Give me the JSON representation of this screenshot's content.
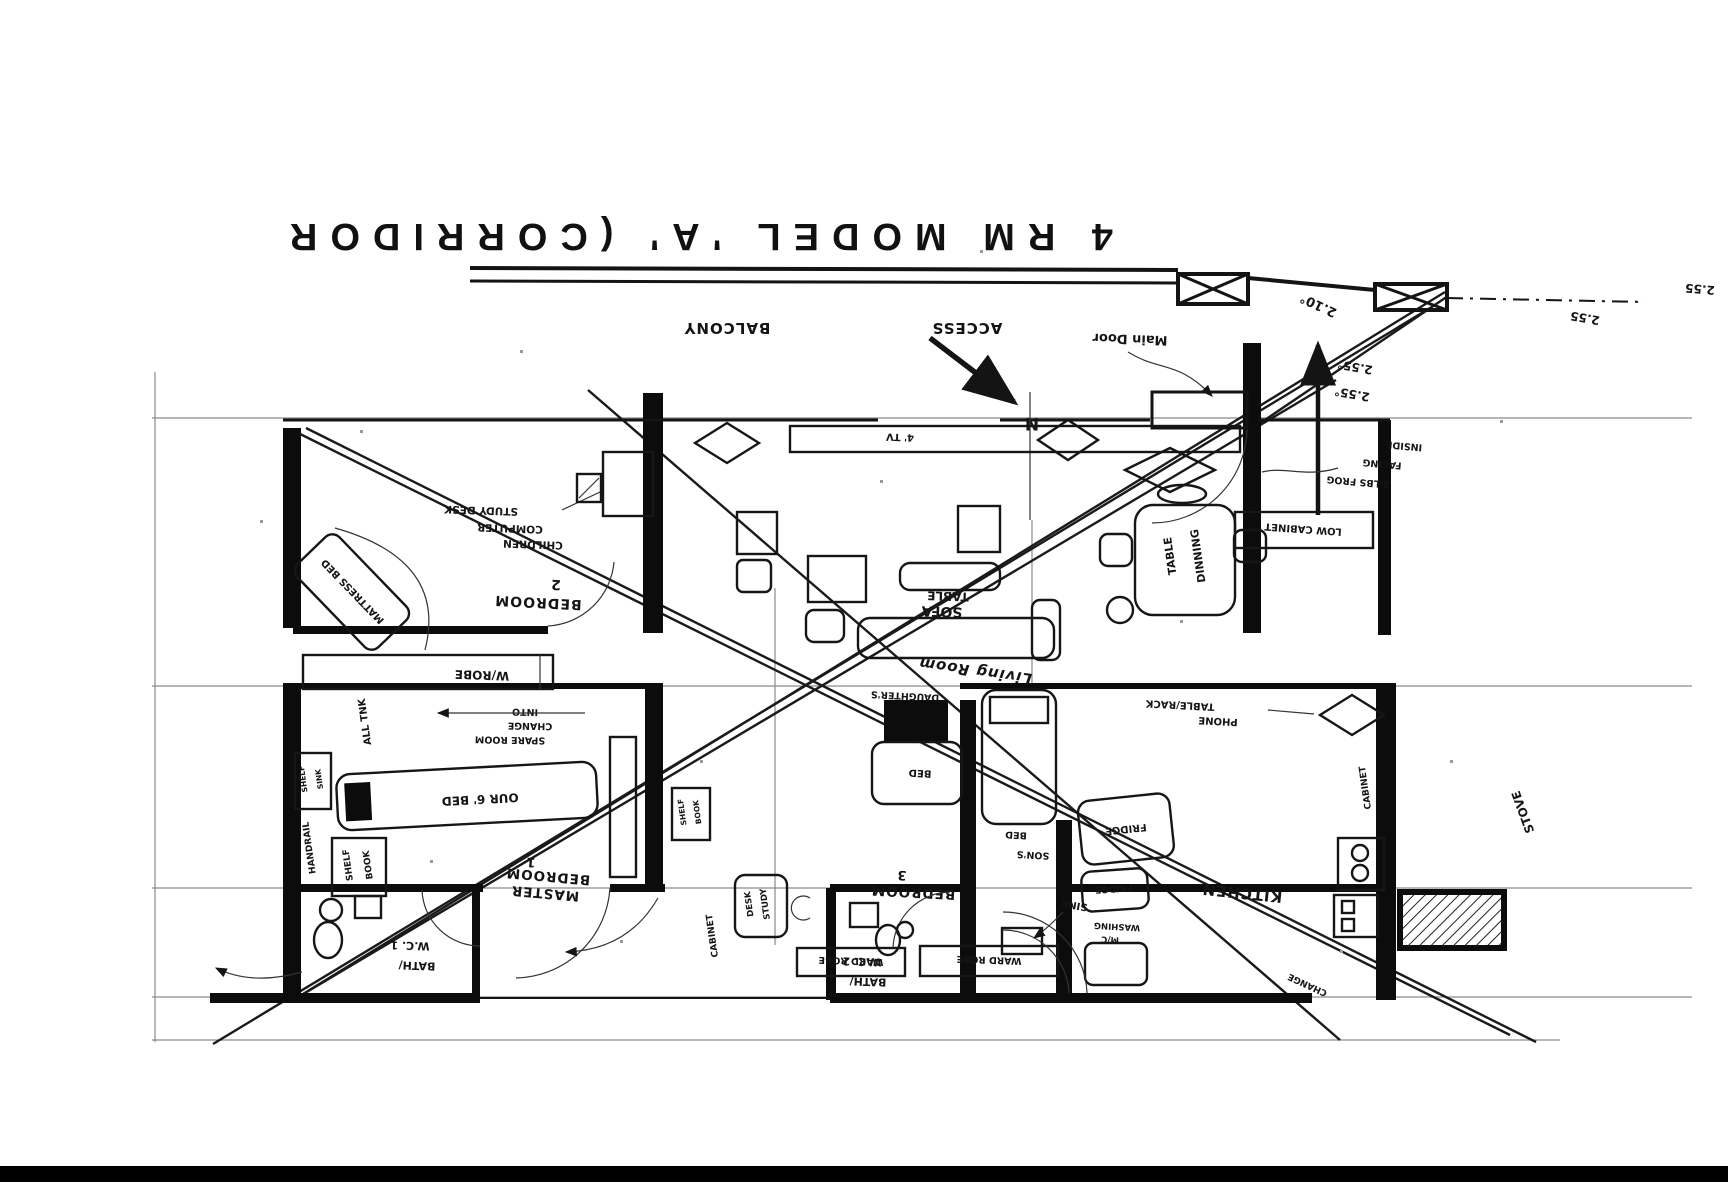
{
  "scan": {
    "title": "4 RM MODEL 'A' (CORRIDOR",
    "dims": {
      "d255_edge": "2.55",
      "d255_mid": "2.55",
      "d255a": "2.55°",
      "d255b": "2.55°",
      "bearing": "2.10°"
    },
    "balcony": {
      "access": "ACCESS",
      "name": "BALCONY"
    },
    "compass": {
      "north": "N"
    },
    "entry": {
      "main_door": "Main Door",
      "change": "CHANGE"
    },
    "living": {
      "name": "Living Room",
      "sofa": "SOFA",
      "sofa_table": "TABLE",
      "tv": "4' TV"
    },
    "dining": {
      "table_l1": "DINNING",
      "table_l2": "TABLE",
      "low_cabinet": "LOW CABINET",
      "phone_l1": "TABLE/RACK",
      "phone_l2": "PHONE",
      "note_l1": "INSIDE",
      "note_l2": "FACING",
      "note_l3": "3 LBS FROG"
    },
    "bedroom2": {
      "name": "BEDROOM",
      "number": "2",
      "mattress_bed": "MATTRESS BED",
      "desk_l1": "STUDY DESK",
      "desk_l2": "COMPUTER",
      "desk_l3": "CHILDREN",
      "wardrobe": "W/ROBE"
    },
    "corridor": {
      "tank": "ALL TNK",
      "spare_l1": "INTO",
      "spare_l2": "CHANGE",
      "spare_l3": "SPARE ROOM"
    },
    "master": {
      "name_l1": "BEDROOM",
      "number": "1",
      "name_l2": "MASTER",
      "bed": "OUR 6' BED",
      "shelf_l1": "BOOK",
      "shelf_l2": "SHELF",
      "sink_shelf_l1": "SINK",
      "sink_shelf_l2": "SHELF",
      "handrail": "HANDRAIL"
    },
    "bedroom3": {
      "number": "3",
      "name": "BEDROOM",
      "study_l1": "STUDY",
      "study_l2": "DESK",
      "daughters_l1": "DAUGHTER'S",
      "daughters_l2": "BED",
      "sons_l1": "BED",
      "sons_l2": "SON'S",
      "wardrobe1": "WARD ROBE",
      "wardrobe2": "WARD ROBE",
      "cabinet": "CABINET",
      "shelf_l1": "BOOK",
      "shelf_l2": "SHELF"
    },
    "kitchen": {
      "name": "KITCHEN",
      "fridge1": "FRIDGE",
      "fridge2": "FRIDGE",
      "washing_l1": "WASHING",
      "washing_l2": "M/C",
      "sink": "SINK",
      "cabinet": "CABINET",
      "stove": "STOVE"
    },
    "bath1": {
      "l1": "BATH/",
      "l2": "W.C. 1"
    },
    "bath2": {
      "l1": "BATH/",
      "l2": "W.C. 2"
    }
  }
}
